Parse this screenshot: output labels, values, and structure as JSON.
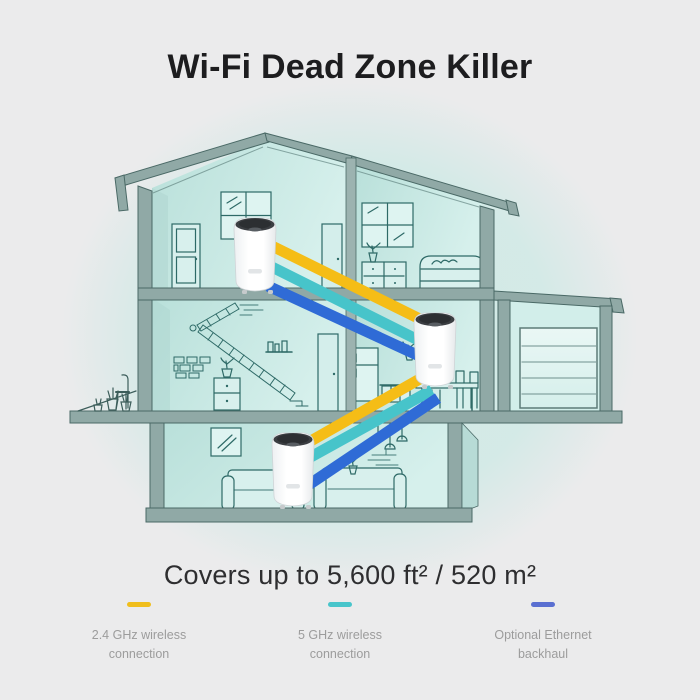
{
  "title": "Wi-Fi Dead Zone Killer",
  "coverage": "Covers up to 5,600 ft² / 520 m²",
  "legend": {
    "items": [
      {
        "label": "2.4 GHz wireless connection",
        "dash_color": "#F0BE1C"
      },
      {
        "label": "5 GHz wireless connection",
        "dash_color": "#48C5CB"
      },
      {
        "label": "Optional Ethernet backhaul",
        "dash_color": "#5A6FD1"
      }
    ]
  },
  "diagram": {
    "devices": [
      "mesh-unit-attic",
      "mesh-unit-middle-floor",
      "mesh-unit-ground-floor"
    ],
    "connections": {
      "wireless_24ghz": "#F5BD16",
      "wireless_5ghz": "#47C4CA",
      "ethernet_backhaul": "#2F6BD6"
    }
  }
}
